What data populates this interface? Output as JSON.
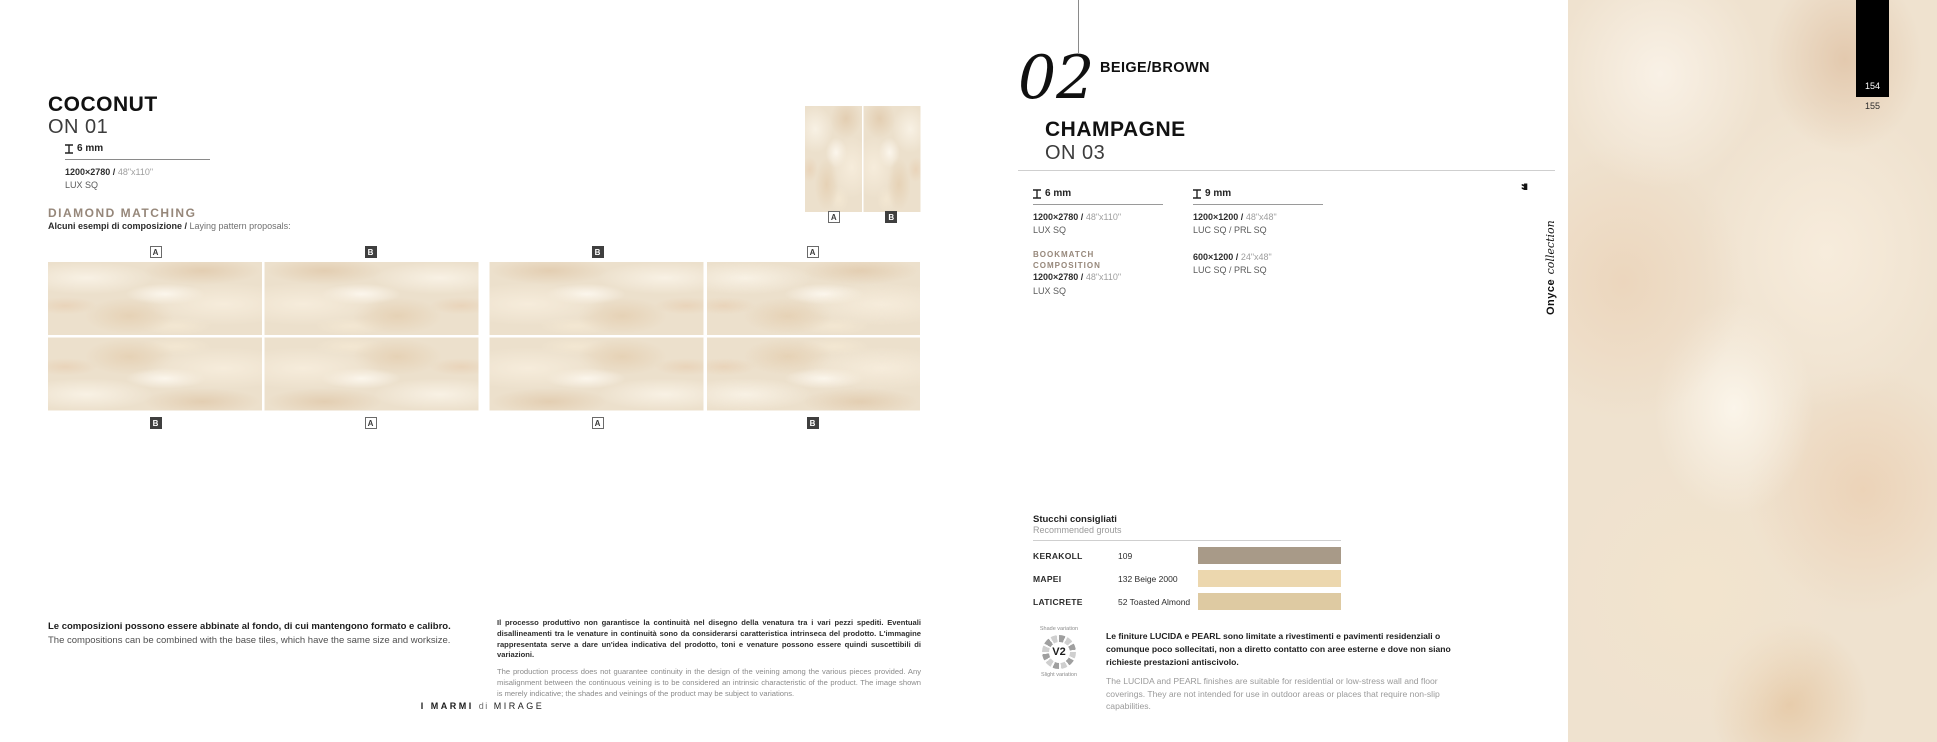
{
  "left_page": {
    "title": "COCONUT",
    "code": "ON 01",
    "thickness_label": "6 mm",
    "format_size": "1200×2780 /",
    "format_inches": "48\"x110\"",
    "format_finish": "LUX SQ",
    "diamond": {
      "title": "DIAMOND MATCHING",
      "subtitle_it": "Alcuni esempi di composizione /",
      "subtitle_en": " Laying pattern proposals:"
    },
    "pair_labels": [
      {
        "t": "A",
        "v": "outline"
      },
      {
        "t": "B",
        "v": "dark"
      }
    ],
    "composition1": {
      "top": [
        {
          "t": "A",
          "v": "outline"
        },
        {
          "t": "B",
          "v": "dark"
        }
      ],
      "bottom": [
        {
          "t": "B",
          "v": "dark"
        },
        {
          "t": "A",
          "v": "outline"
        }
      ]
    },
    "composition2": {
      "top": [
        {
          "t": "B",
          "v": "dark"
        },
        {
          "t": "A",
          "v": "outline"
        }
      ],
      "bottom": [
        {
          "t": "A",
          "v": "outline"
        },
        {
          "t": "B",
          "v": "dark"
        }
      ]
    },
    "note_it": "Le composizioni possono essere abbinate al fondo, di cui mantengono formato e calibro.",
    "note_en": "The compositions can be combined with the base tiles, which have the same size and worksize.",
    "disclaimer_it": "Il processo produttivo non garantisce la continuità nel disegno della venatura tra i vari pezzi spediti. Eventuali disallineamenti tra le venature in continuità sono da considerarsi caratteristica intrinseca del prodotto. L'immagine rappresentata serve a dare un'idea indicativa del prodotto, toni e venature possono essere quindi suscettibili di variazioni.",
    "disclaimer_en": "The production process does not guarantee continuity in the design of the veining among the various pieces provided. Any misalignment between the continuous veining is to be considered an intrinsic characteristic of the product. The image shown is merely indicative; the shades and veinings of the product may be subject to variations.",
    "footer": {
      "brand": "I MARMI",
      "di": "di",
      "company": "MIRAGE"
    }
  },
  "right_page": {
    "section_number": "02",
    "section_title": "BEIGE/BROWN",
    "title": "CHAMPAGNE",
    "code": "ON 03",
    "col1": {
      "thickness": "6 mm",
      "item1_size": "1200×2780 /",
      "item1_inches": "48\"x110\"",
      "item1_finish": "LUX SQ",
      "bookmatch_label": "BOOKMATCH COMPOSITION",
      "item2_size": "1200×2780 /",
      "item2_inches": "48\"x110\"",
      "item2_finish": "LUX SQ"
    },
    "col2": {
      "thickness": "9 mm",
      "item1_size": "1200×1200 /",
      "item1_inches": "48\"x48\"",
      "item1_finish": "LUC SQ / PRL SQ",
      "item2_size": "600×1200 /",
      "item2_inches": "24\"x48\"",
      "item2_finish": "LUC SQ / PRL SQ"
    },
    "collection": {
      "quote": "❝",
      "name": "Onyce",
      "suffix": "collection"
    },
    "grouts": {
      "title_it": "Stucchi consigliati",
      "title_en": "Recommended grouts",
      "rows": [
        {
          "brand": "KERAKOLL",
          "ref": "109",
          "color": "#a89a88"
        },
        {
          "brand": "MAPEI",
          "ref": "132 Beige 2000",
          "color": "#ecd7ae"
        },
        {
          "brand": "LATICRETE",
          "ref": "52 Toasted Almond",
          "color": "#decaa2"
        }
      ]
    },
    "variation": {
      "top": "Shade variation",
      "badge": "V2",
      "bottom": "Slight variation"
    },
    "finish_note_it": "Le finiture LUCIDA e PEARL sono limitate a rivestimenti e pavimenti residenziali o comunque poco sollecitati, non a diretto contatto con aree esterne e dove non siano richieste prestazioni antiscivolo.",
    "finish_note_en": "The LUCIDA and PEARL finishes are suitable for residential or low-stress wall and floor coverings. They are not intended for use in outdoor areas or places that require non-slip capabilities."
  },
  "page_numbers": {
    "current": "154",
    "next": "155"
  }
}
